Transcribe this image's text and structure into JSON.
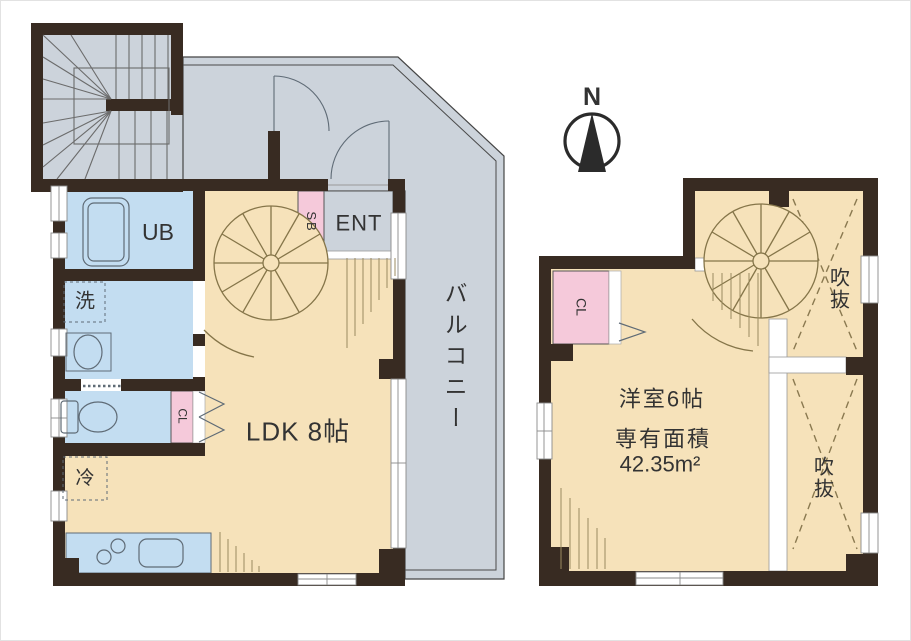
{
  "colors": {
    "wall": "#382b22",
    "floor": "#f6e2ba",
    "wet_area": "#c3ddf1",
    "closet": "#f5c9da",
    "balcony": "#ccd3db",
    "stair_line": "#857549",
    "hatch_line": "#9b8b60",
    "fixture_line": "#5f6b76",
    "text": "#333333"
  },
  "compass": {
    "label": "N"
  },
  "floor1": {
    "ldk": "LDK 8帖",
    "unit_bath": "UB",
    "laundry": "洗",
    "refrigerator": "冷",
    "shoe_box": "SB",
    "entrance": "ENT",
    "closet": "CL",
    "balcony": "バルコニー"
  },
  "floor2": {
    "bedroom": "洋室6帖",
    "area_caption": "専有面積",
    "area_value": "42.35m²",
    "closet": "CL",
    "void_upper": "吹抜",
    "void_lower": "吹抜"
  }
}
